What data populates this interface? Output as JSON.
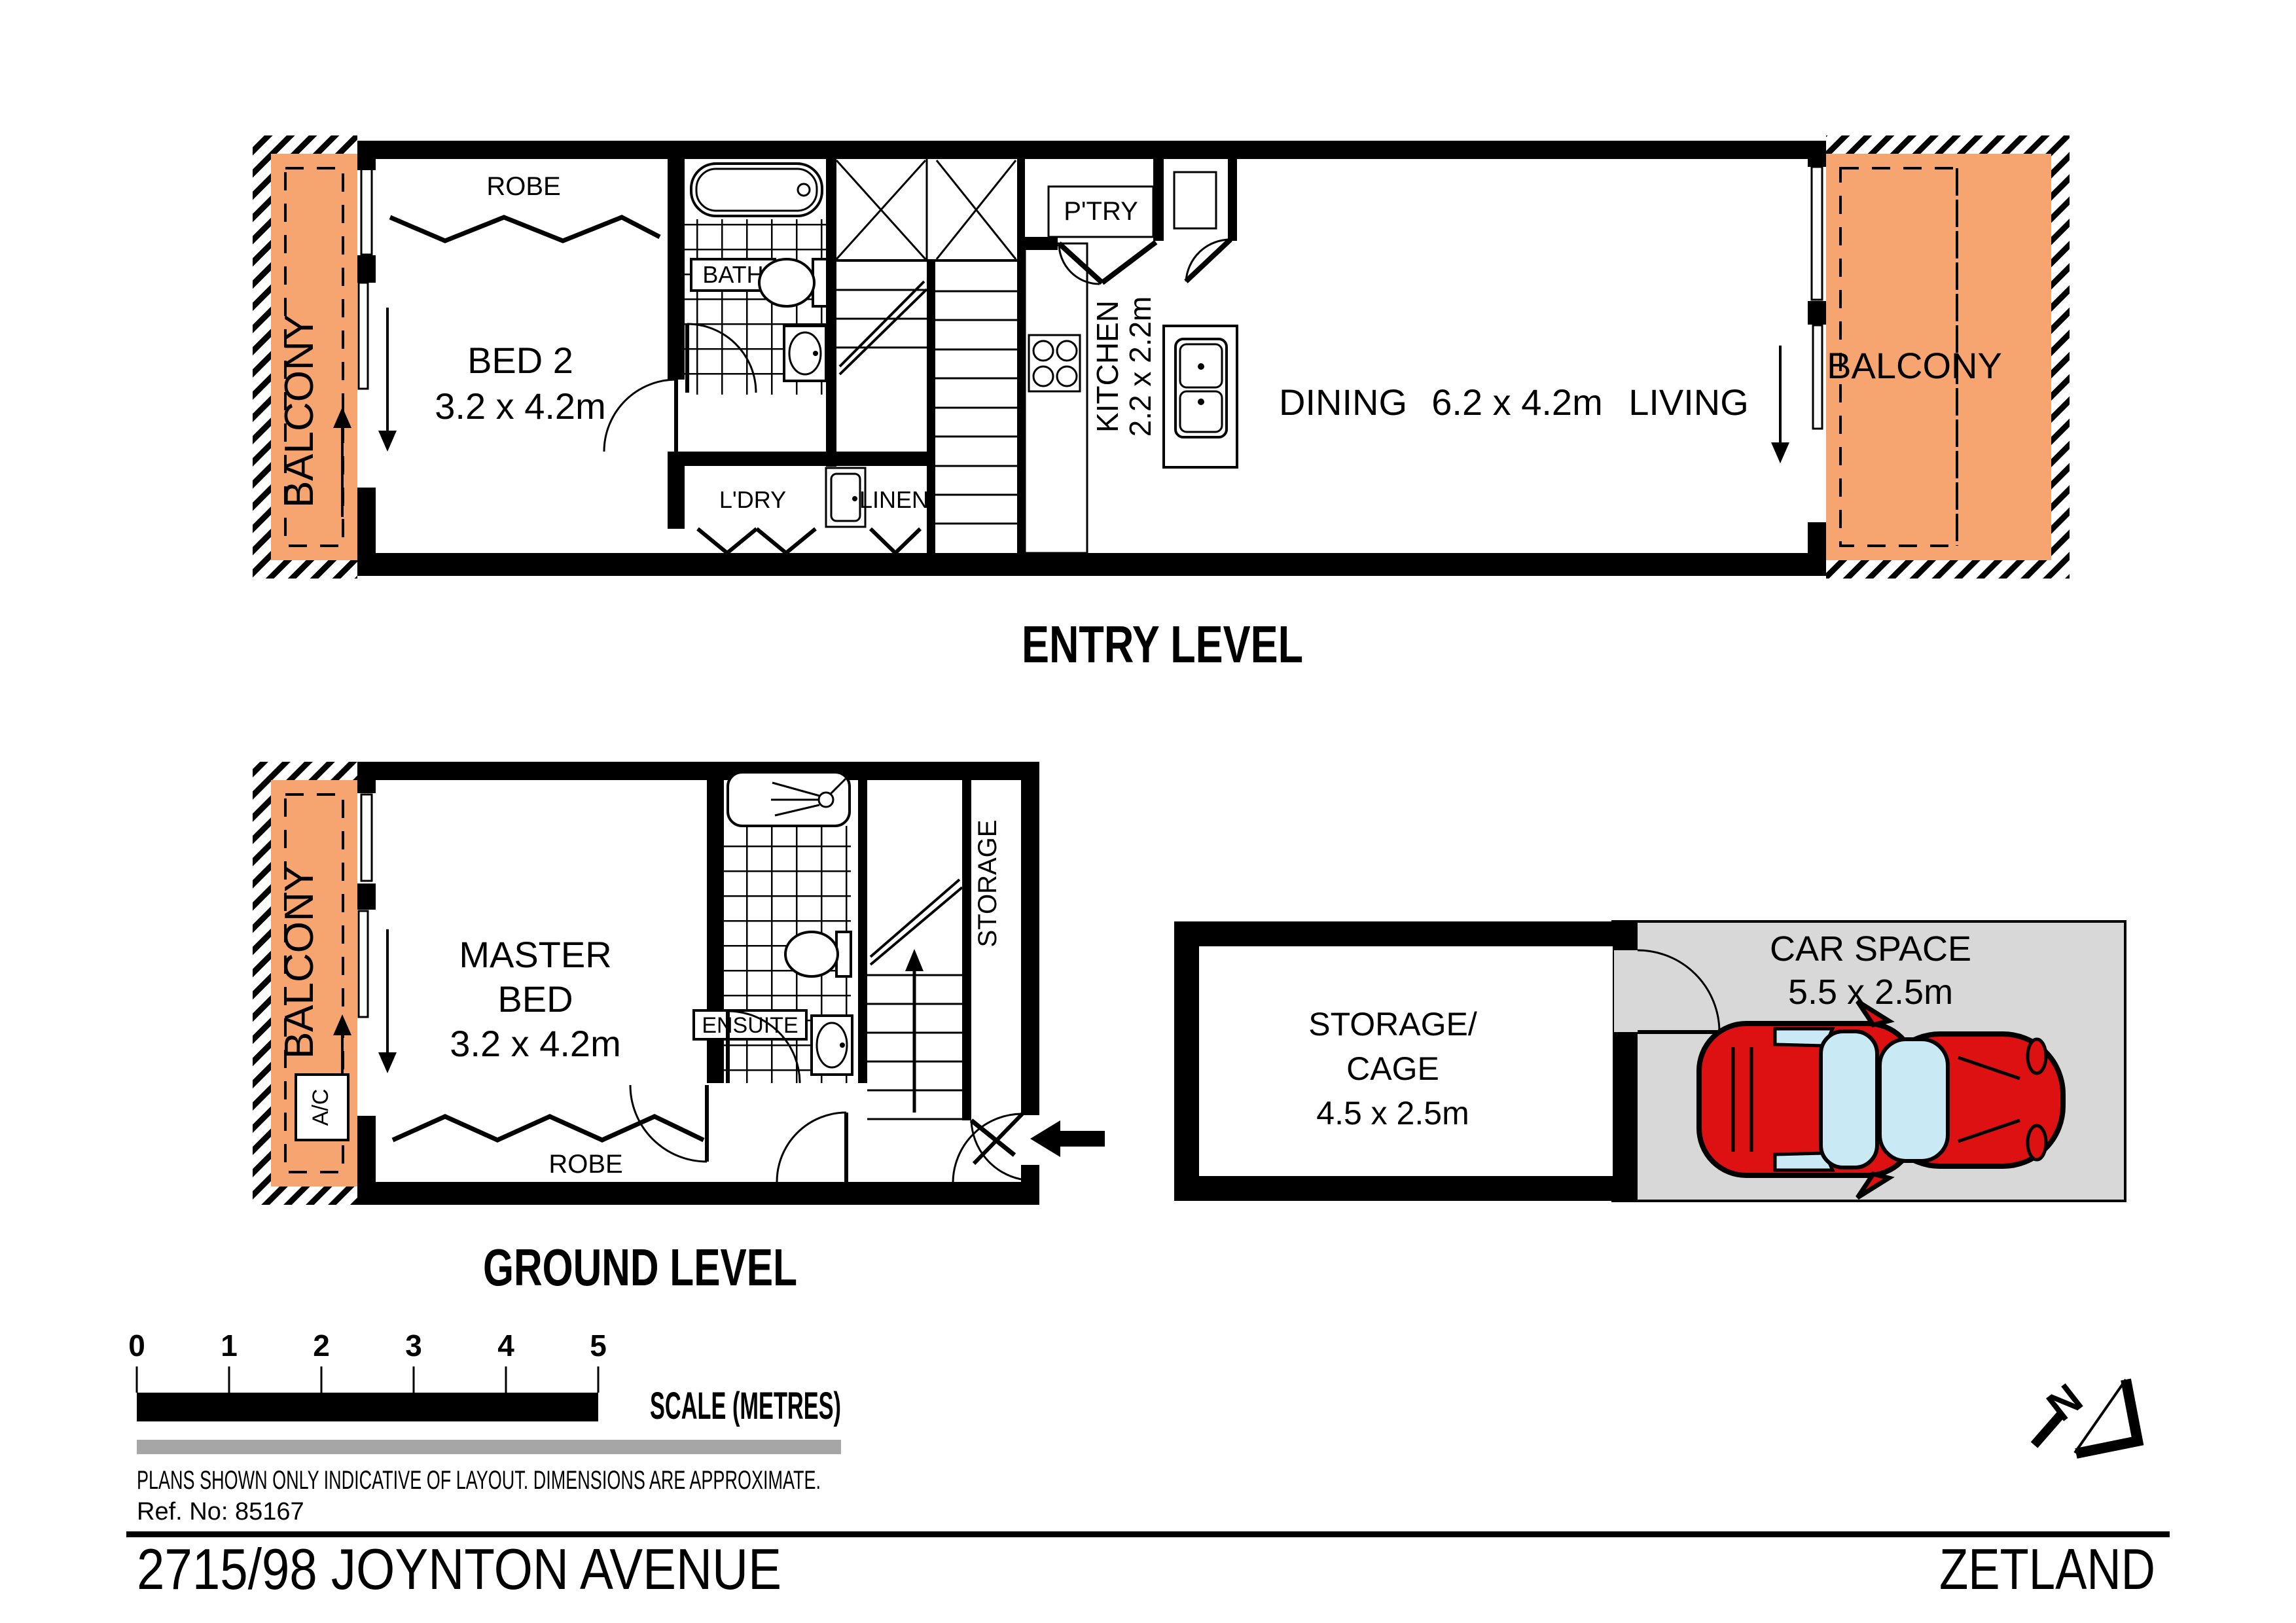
{
  "titles": {
    "entry": "ENTRY LEVEL",
    "ground": "GROUND LEVEL"
  },
  "labels": {
    "balcony": "BALCONY",
    "robe": "ROBE",
    "bed2": "BED 2",
    "bed2_dim": "3.2 x 4.2m",
    "bath": "BATH",
    "ldry": "L'DRY",
    "linen": "LINEN",
    "ptry": "P'TRY",
    "kitchen": "KITCHEN",
    "kitchen_dim": "2.2 x 2.2m",
    "dining": "DINING",
    "living_dim": "6.2 x 4.2m",
    "living": "LIVING",
    "master_line1": "MASTER",
    "master_line2": "BED",
    "master_dim": "3.2 x 4.2m",
    "ensuite": "ENSUITE",
    "storage": "STORAGE",
    "ac": "A/C",
    "cage_line1": "STORAGE/",
    "cage_line2": "CAGE",
    "cage_dim": "4.5 x 2.5m",
    "carspace": "CAR SPACE",
    "carspace_dim": "5.5 x 2.5m",
    "north": "N"
  },
  "scale_bar": {
    "ticks": [
      "0",
      "1",
      "2",
      "3",
      "4",
      "5"
    ],
    "label": "SCALE (METRES)"
  },
  "footer": {
    "disclaimer": "PLANS SHOWN ONLY INDICATIVE OF LAYOUT.  DIMENSIONS ARE APPROXIMATE.",
    "ref": "Ref. No: 85167",
    "address": "2715/98 JOYNTON AVENUE",
    "suburb": "ZETLAND"
  },
  "colors": {
    "balcony": "#F6A470",
    "carspace": "#D8D8D8",
    "car": "#DD1111",
    "glass": "#C9E9F4",
    "grey_bar": "#A6A6A6"
  }
}
